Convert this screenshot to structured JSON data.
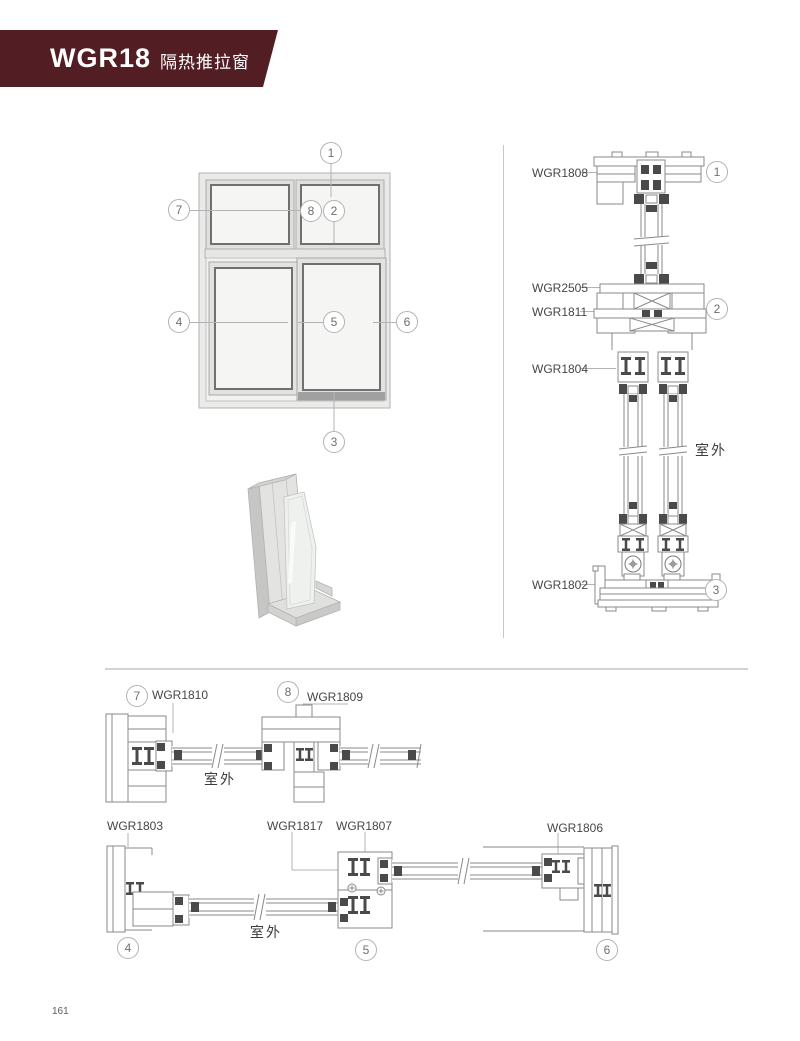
{
  "banner": {
    "code": "WGR18",
    "title": "隔热推拉窗"
  },
  "colors": {
    "banner_bg": "#521e23",
    "banner_ink": "#ffffff",
    "callout_border": "#b2b2b2",
    "line": "#8a8a8a",
    "dark": "#4a4a4a"
  },
  "callouts": {
    "c1": "1",
    "c2": "2",
    "c3": "3",
    "c4": "4",
    "c5": "5",
    "c6": "6",
    "c7": "7",
    "c8": "8"
  },
  "parts": {
    "wgr1808": "WGR1808",
    "wgr2505": "WGR2505",
    "wgr1811": "WGR1811",
    "wgr1804": "WGR1804",
    "wgr1802": "WGR1802",
    "wgr1810": "WGR1810",
    "wgr1809": "WGR1809",
    "wgr1803": "WGR1803",
    "wgr1817": "WGR1817",
    "wgr1807": "WGR1807",
    "wgr1806": "WGR1806"
  },
  "outside_label": "室外",
  "page_number": "161"
}
